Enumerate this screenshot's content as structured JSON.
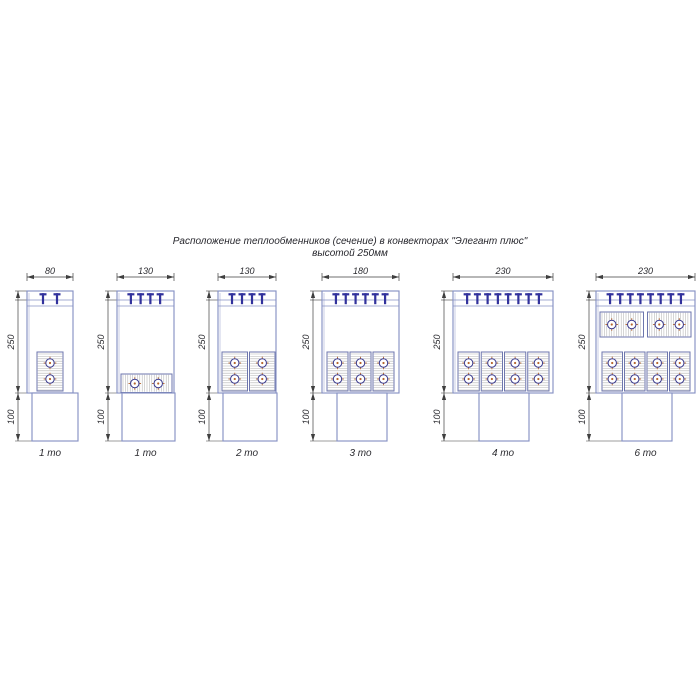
{
  "title": {
    "line1": "Расположение теплообменников (сечение) в конвекторах \"Элегант плюс\"",
    "line2": "высотой 250мм"
  },
  "common_dims": {
    "height_upper": "250",
    "height_lower": "100"
  },
  "colors": {
    "outline_blue": "#8691c4",
    "grille_navy": "#31319c",
    "hatch_gray": "#b3b3b3",
    "block_border": "#6d76ad",
    "tube_ring": "#3a3a8e",
    "tube_cross_orange": "#b5652d",
    "dimension_gray": "#3f3f3f",
    "text_dark": "#2b2b30"
  },
  "drawings": [
    {
      "label": "1 то",
      "width_label": "80",
      "teeth": 2,
      "dim_x": 18,
      "casing": {
        "x": 27,
        "w": 46
      },
      "pedestal": {
        "x": 32,
        "w": 46
      },
      "vertical_blocks": {
        "x": 37,
        "w": 26,
        "count": 1
      },
      "horizontal_blocks_bottom": null,
      "horizontal_blocks_top": null,
      "tubes_total": 2
    },
    {
      "label": "1 то",
      "width_label": "130",
      "teeth": 4,
      "dim_x": 108,
      "casing": {
        "x": 117,
        "w": 57
      },
      "pedestal": {
        "x": 122,
        "w": 53
      },
      "vertical_blocks": null,
      "horizontal_blocks_bottom": {
        "x": 121,
        "w": 51,
        "count": 1
      },
      "horizontal_blocks_top": null,
      "tubes_total": 2
    },
    {
      "label": "2 то",
      "width_label": "130",
      "teeth": 4,
      "dim_x": 209,
      "casing": {
        "x": 218,
        "w": 58
      },
      "pedestal": {
        "x": 223,
        "w": 54
      },
      "vertical_blocks": {
        "x": 222,
        "w": 53,
        "count": 2
      },
      "horizontal_blocks_bottom": null,
      "horizontal_blocks_top": null,
      "tubes_total": 4
    },
    {
      "label": "3 то",
      "width_label": "180",
      "teeth": 6,
      "dim_x": 313,
      "casing": {
        "x": 322,
        "w": 77
      },
      "pedestal": {
        "x": 337,
        "w": 50
      },
      "vertical_blocks": {
        "x": 327,
        "w": 67,
        "count": 3
      },
      "horizontal_blocks_bottom": null,
      "horizontal_blocks_top": null,
      "tubes_total": 6
    },
    {
      "label": "4 то",
      "width_label": "230",
      "teeth": 8,
      "dim_x": 444,
      "casing": {
        "x": 453,
        "w": 100
      },
      "pedestal": {
        "x": 479,
        "w": 50
      },
      "vertical_blocks": {
        "x": 458,
        "w": 91,
        "count": 4
      },
      "horizontal_blocks_bottom": null,
      "horizontal_blocks_top": null,
      "tubes_total": 8
    },
    {
      "label": "6 то",
      "width_label": "230",
      "teeth": 8,
      "dim_x": 589,
      "casing": {
        "x": 596,
        "w": 99
      },
      "pedestal": {
        "x": 622,
        "w": 50
      },
      "vertical_blocks": {
        "x": 602,
        "w": 88,
        "count": 4
      },
      "horizontal_blocks_bottom": null,
      "horizontal_blocks_top": {
        "x": 600,
        "w": 91,
        "count": 2
      },
      "tubes_total": 12
    }
  ]
}
